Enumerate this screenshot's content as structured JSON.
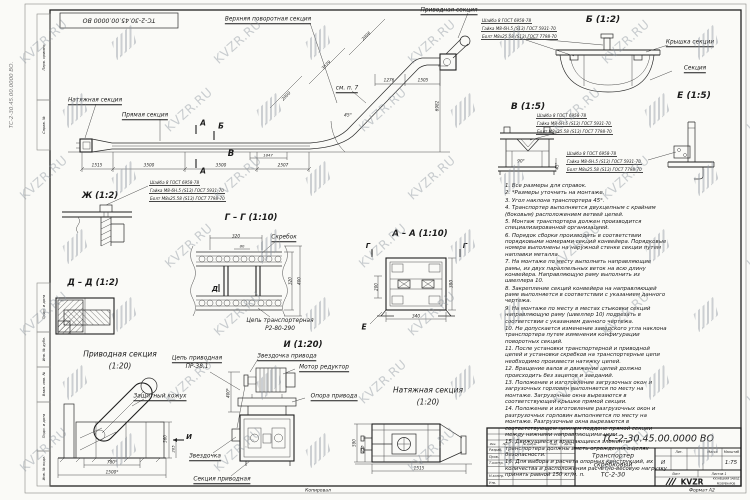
{
  "watermark": {
    "text": "KVZR.RU"
  },
  "fastener_callout": {
    "lines": [
      "Шайба 8 ГОСТ 6958-78",
      "Гайка М8-6Н.5 (S13) ГОСТ 5931-70",
      "Болт М8х25.58 (S13) ГОСТ 7798-70"
    ],
    "positions": [
      {
        "x": 481,
        "y": 18
      },
      {
        "x": 536,
        "y": 113
      },
      {
        "x": 566,
        "y": 151
      },
      {
        "x": 149,
        "y": 180
      }
    ]
  },
  "notes": [
    "1. Все размеры для справок.",
    "2. *Размеры уточнить на монтаже.",
    "3. Угол наклона транспортера 45°.",
    "4. Транспортер выполняется двухцепным с крайним (боковым) расположением ветвей цепей.",
    "5. Монтаж транспортера должен производится специализированной организацией.",
    "6. Порядок сборки производить в соответствии порядковыми номерами секций конвейера. Порядковые номера выполнены на наружной стенке секции путем наплавки металла.",
    "7. На монтаже по месту выполнить направляющие рамы, из двух параллельных веток на всю длину конвейера. Направляющую раму выполнить из швеллера 10.",
    "8. Закрепление секций конвейера на направляющей раме выполняется в соответствии с указанием данного чертежа.",
    "9. На монтаже по месту в местах стыковки секций направляющую раму (швеллер 10) подрезать в соответствии с указанием данного чертежа.",
    "10. Не допускается изменение заводского угла наклона транспортера путем изменения конфигурации поворотных секций.",
    "11. После установки транспортерной и приводной цепей и установки скребков на транспортерные цепи необходимо произвести натяжку цепей.",
    "12. Вращение валов и движение цепей должно происходить без зацепов и заеданий.",
    "13. Положение и изготовление загрузочных окон и загрузочных горловин выполняется по месту на монтаже. Загрузочные окна вырезаются в соответствующей крышке прямой секции.",
    "14. Положение и изготовление разгрузочных окон и разгрузочных горловин выполняется по месту на монтаже. Разгрузочные окна вырезаются в соответствующем нижнем поддоне прямой секции между нижними направляющими цепи.",
    "15. Движущиеся и вращающиеся элементы транспортера должны иметь ограждения в целях безопасности.",
    "16. Для выбора и расчета опорных конструкций, их количества и расположения расчетно-весовую нагрузку принять равной 150 кг/м. п."
  ],
  "text_groups": [
    {
      "name": "frame",
      "items": [
        {
          "n": "doc-number-top-flipped",
          "t": "ТС-2-30.45.00.0000 ВО",
          "x": 119,
          "y": 20,
          "s": 6.2,
          "r": 180
        },
        {
          "n": "doc-number-margin-vertical",
          "t": "ТС-2-30.45.00.0000 ВО.",
          "x": 12,
          "y": 95,
          "s": 5.5,
          "r": -90,
          "col": "#7d7d7d"
        },
        {
          "n": "stamp-inv-podl",
          "t": "Инв. № подл.",
          "x": 43.5,
          "y": 468,
          "s": 3.6,
          "r": -90
        },
        {
          "n": "stamp-podp-data-1",
          "t": "Подп. и дата",
          "x": 43.5,
          "y": 426,
          "s": 3.6,
          "r": -90
        },
        {
          "n": "stamp-vzam-inv",
          "t": "Взам. инв. №",
          "x": 43.5,
          "y": 384,
          "s": 3.6,
          "r": -90
        },
        {
          "n": "stamp-inv-dubl",
          "t": "Инв. № дубл.",
          "x": 43.5,
          "y": 349,
          "s": 3.6,
          "r": -90
        },
        {
          "n": "stamp-podp-data-2",
          "t": "Подп. и дата",
          "x": 43.5,
          "y": 307,
          "s": 3.6,
          "r": -90
        },
        {
          "n": "stamp-sprav",
          "t": "Справ. №",
          "x": 43.5,
          "y": 125,
          "s": 3.6,
          "r": -90
        },
        {
          "n": "stamp-perv-primen",
          "t": "Перв. примен.",
          "x": 43.5,
          "y": 57,
          "s": 3.6,
          "r": -90
        },
        {
          "n": "copied-by",
          "t": "Копировал",
          "x": 318,
          "y": 490.5,
          "s": 4.5
        },
        {
          "n": "sheet-format",
          "t": "Формат А2",
          "x": 702,
          "y": 490.5,
          "s": 4.5
        }
      ]
    },
    {
      "name": "main-elevation",
      "items": [
        {
          "n": "label-tension-section",
          "t": "Натяжная секция",
          "x": 95,
          "y": 101,
          "s": 5.8,
          "u": 1
        },
        {
          "n": "label-straight-section",
          "t": "Прямая секция",
          "x": 145,
          "y": 116,
          "s": 5.8,
          "u": 1
        },
        {
          "n": "label-upper-turn-section",
          "t": "Верхняя поворотная секция",
          "x": 268,
          "y": 20,
          "s": 5.8,
          "u": 1
        },
        {
          "n": "label-drive-section",
          "t": "Приводная секция",
          "x": 449,
          "y": 11,
          "s": 5.8,
          "u": 1
        },
        {
          "n": "label-see-item7",
          "t": "см. п. 7",
          "x": 347,
          "y": 89,
          "s": 5.8,
          "u": 1
        },
        {
          "n": "mark-a-top",
          "t": "А",
          "x": 203,
          "y": 123,
          "s": 7.5,
          "b": 1
        },
        {
          "n": "mark-a-bottom",
          "t": "А",
          "x": 203,
          "y": 171,
          "s": 7.5,
          "b": 1
        },
        {
          "n": "mark-b",
          "t": "Б",
          "x": 221,
          "y": 126,
          "s": 7.5,
          "b": 1
        },
        {
          "n": "mark-v",
          "t": "В",
          "x": 231,
          "y": 154,
          "s": 8.5,
          "b": 1
        },
        {
          "n": "dim-1515",
          "t": "1515",
          "x": 97,
          "y": 165,
          "s": 4.2
        },
        {
          "n": "dim-3500-1",
          "t": "3500",
          "x": 149,
          "y": 165,
          "s": 4.2
        },
        {
          "n": "dim-3500-2",
          "t": "3500",
          "x": 221,
          "y": 165,
          "s": 4.2
        },
        {
          "n": "dim-2507",
          "t": "2507",
          "x": 283,
          "y": 165,
          "s": 4.2
        },
        {
          "n": "dim-1847",
          "t": "1847",
          "x": 268,
          "y": 155,
          "s": 3.8
        },
        {
          "n": "dim-6982",
          "t": "6982",
          "x": 437,
          "y": 106,
          "s": 4.2,
          "r": -90
        },
        {
          "n": "dim-1276",
          "t": "1276",
          "x": 389,
          "y": 80,
          "s": 4.2
        },
        {
          "n": "dim-1505",
          "t": "1505",
          "x": 423,
          "y": 80,
          "s": 4.2
        },
        {
          "n": "dim-2006",
          "t": "2006",
          "x": 366,
          "y": 36,
          "s": 4.2,
          "r": -45
        },
        {
          "n": "dim-3539",
          "t": "3539",
          "x": 326,
          "y": 65,
          "s": 4.2,
          "r": -45
        },
        {
          "n": "dim-2000",
          "t": "2000",
          "x": 286,
          "y": 96,
          "s": 4.2,
          "r": -45
        },
        {
          "n": "dim-45deg",
          "t": "45°",
          "x": 348,
          "y": 116,
          "s": 4.5
        }
      ]
    },
    {
      "name": "view-b",
      "items": [
        {
          "n": "view-b-title",
          "t": "Б (1:2)",
          "x": 603,
          "y": 20,
          "s": 9,
          "b": 1
        },
        {
          "n": "label-section-cover",
          "t": "Крышка секции",
          "x": 690,
          "y": 43,
          "s": 5.8,
          "u": 1
        },
        {
          "n": "label-section",
          "t": "Секция",
          "x": 695,
          "y": 69,
          "s": 5.8,
          "u": 1
        }
      ]
    },
    {
      "name": "view-v",
      "items": [
        {
          "n": "view-v-title",
          "t": "В (1:5)",
          "x": 528,
          "y": 107,
          "s": 9,
          "b": 1
        },
        {
          "n": "dim-90deg",
          "t": "90°",
          "x": 521,
          "y": 161,
          "s": 4.2
        },
        {
          "n": "dim-45deg-v",
          "t": "45°",
          "x": 557,
          "y": 166,
          "s": 4,
          "r": -90
        }
      ]
    },
    {
      "name": "view-e",
      "items": [
        {
          "n": "view-e-title",
          "t": "Е (1:5)",
          "x": 694,
          "y": 96,
          "s": 9,
          "b": 1
        }
      ]
    },
    {
      "name": "view-zh",
      "items": [
        {
          "n": "view-zh-title",
          "t": "Ж (1:2)",
          "x": 100,
          "y": 196,
          "s": 8.5,
          "b": 1
        }
      ]
    },
    {
      "name": "view-gg",
      "items": [
        {
          "n": "view-gg-title",
          "t": "Г – Г (1:10)",
          "x": 251,
          "y": 218,
          "s": 8.5,
          "b": 1
        },
        {
          "n": "label-scraper",
          "t": "Скребок",
          "x": 284,
          "y": 238,
          "s": 5.8,
          "u": 1
        },
        {
          "n": "label-conveyor-chain-1",
          "t": "Цепь транспортерная",
          "x": 280,
          "y": 321,
          "s": 5.8
        },
        {
          "n": "label-conveyor-chain-2",
          "t": "Р2-80-290",
          "x": 280,
          "y": 329,
          "s": 5.8
        },
        {
          "n": "mark-d",
          "t": "Д",
          "x": 215,
          "y": 289,
          "s": 7,
          "b": 1
        },
        {
          "n": "dim-320-top",
          "t": "320",
          "x": 236,
          "y": 235.5,
          "s": 4.2
        },
        {
          "n": "dim-80",
          "t": "80",
          "x": 242,
          "y": 246,
          "s": 3.8
        },
        {
          "n": "dim-320-right",
          "t": "320",
          "x": 290,
          "y": 281,
          "s": 4,
          "r": -90
        },
        {
          "n": "dim-400",
          "t": "400",
          "x": 299,
          "y": 281,
          "s": 4,
          "r": -90
        }
      ]
    },
    {
      "name": "view-aa",
      "items": [
        {
          "n": "view-aa-title",
          "t": "А – А (1:10)",
          "x": 420,
          "y": 234,
          "s": 8.5,
          "b": 1
        },
        {
          "n": "mark-g-left",
          "t": "Г",
          "x": 368,
          "y": 246,
          "s": 7,
          "b": 1
        },
        {
          "n": "mark-g-right",
          "t": "Г",
          "x": 465,
          "y": 246,
          "s": 7,
          "b": 1
        },
        {
          "n": "mark-e",
          "t": "Е",
          "x": 364,
          "y": 327,
          "s": 7.5,
          "b": 1
        },
        {
          "n": "dim-340",
          "t": "340",
          "x": 416,
          "y": 316,
          "s": 4.2
        },
        {
          "n": "dim-380",
          "t": "380",
          "x": 451,
          "y": 284,
          "s": 4.2,
          "r": -90
        },
        {
          "n": "dim-200",
          "t": "200",
          "x": 376,
          "y": 287,
          "s": 4,
          "r": -90
        }
      ]
    },
    {
      "name": "view-dd",
      "items": [
        {
          "n": "view-dd-title",
          "t": "Д – Д (1:2)",
          "x": 93,
          "y": 283,
          "s": 8.5,
          "b": 1
        }
      ]
    },
    {
      "name": "view-i",
      "items": [
        {
          "n": "view-i-title",
          "t": "И (1:20)",
          "x": 303,
          "y": 345,
          "s": 8.5,
          "b": 1
        },
        {
          "n": "label-drive-sprocket",
          "t": "Звездочка привода",
          "x": 287,
          "y": 357,
          "s": 5.8,
          "u": 1
        },
        {
          "n": "label-motor-reducer",
          "t": "Мотор редуктор",
          "x": 324,
          "y": 368,
          "s": 5.8,
          "u": 1
        },
        {
          "n": "label-drive-support",
          "t": "Опора привода",
          "x": 334,
          "y": 397,
          "s": 5.8,
          "u": 1
        },
        {
          "n": "label-drive-chain-1",
          "t": "Цепь приводная",
          "x": 197,
          "y": 359,
          "s": 5.8,
          "u": 1
        },
        {
          "n": "label-drive-chain-2",
          "t": "ПР-38,1",
          "x": 197,
          "y": 367,
          "s": 5.8
        },
        {
          "n": "label-sprocket",
          "t": "Звездочка",
          "x": 205,
          "y": 457,
          "s": 5.8,
          "u": 1
        },
        {
          "n": "label-drive-section-bottom",
          "t": "Секция приводная",
          "x": 222,
          "y": 480,
          "s": 5.8,
          "u": 1
        },
        {
          "n": "dim-400-star",
          "t": "400*",
          "x": 228,
          "y": 393,
          "s": 4,
          "r": -90
        }
      ]
    },
    {
      "name": "view-drive",
      "items": [
        {
          "n": "drive-view-title-1",
          "t": "Приводная секция",
          "x": 120,
          "y": 354,
          "s": 7.5
        },
        {
          "n": "drive-view-title-2",
          "t": "(1:20)",
          "x": 120,
          "y": 366,
          "s": 7.5
        },
        {
          "n": "label-protective-casing",
          "t": "Защитный кожух",
          "x": 160,
          "y": 397,
          "s": 5.8,
          "u": 1
        },
        {
          "n": "dim-560",
          "t": "560",
          "x": 165,
          "y": 439,
          "s": 4,
          "r": -90
        },
        {
          "n": "dim-265",
          "t": "265",
          "x": 172.5,
          "y": 449,
          "s": 3.8,
          "r": -90
        },
        {
          "n": "dim-780-star",
          "t": "780*",
          "x": 112,
          "y": 462,
          "s": 4.2
        },
        {
          "n": "dim-1500-star",
          "t": "1500*",
          "x": 112,
          "y": 472,
          "s": 4.2
        },
        {
          "n": "mark-i",
          "t": "И",
          "x": 189,
          "y": 437,
          "s": 7,
          "b": 1
        }
      ]
    },
    {
      "name": "view-tension",
      "items": [
        {
          "n": "tension-view-title-1",
          "t": "Натяжная секция",
          "x": 428,
          "y": 390,
          "s": 7.5
        },
        {
          "n": "tension-view-title-2",
          "t": "(1:20)",
          "x": 428,
          "y": 402,
          "s": 7.5
        },
        {
          "n": "dim-1515-tension",
          "t": "1515",
          "x": 419,
          "y": 468,
          "s": 4.2
        },
        {
          "n": "dim-590",
          "t": "590",
          "x": 354,
          "y": 443,
          "s": 4,
          "r": -90
        },
        {
          "n": "dim-255",
          "t": "255",
          "x": 362,
          "y": 449,
          "s": 3.8,
          "r": -90
        }
      ]
    },
    {
      "name": "title-block",
      "items": [
        {
          "n": "tb-doc-number",
          "t": "ТС-2-30.45.00.0000 ВО",
          "x": 658,
          "y": 439,
          "s": 9.5
        },
        {
          "n": "tb-name-1",
          "t": "Транспортер",
          "x": 613,
          "y": 456,
          "s": 6.2
        },
        {
          "n": "tb-name-2",
          "t": "скребковый",
          "x": 613,
          "y": 465,
          "s": 6.2
        },
        {
          "n": "tb-name-3",
          "t": "ТС-2-30",
          "x": 613,
          "y": 474.5,
          "s": 6.2
        },
        {
          "n": "tb-col-izm",
          "t": "Изм.",
          "x": 493,
          "y": 443.5,
          "s": 2.8
        },
        {
          "n": "tb-col-list",
          "t": "Лист",
          "x": 506,
          "y": 443.5,
          "s": 2.8
        },
        {
          "n": "tb-col-docnum",
          "t": "№ докум.",
          "x": 530,
          "y": 443.5,
          "s": 2.8
        },
        {
          "n": "tb-col-podp",
          "t": "Подп.",
          "x": 554,
          "y": 443.5,
          "s": 2.8
        },
        {
          "n": "tb-col-data",
          "t": "Дата",
          "x": 568,
          "y": 443.5,
          "s": 2.8
        },
        {
          "n": "tb-row-razrab",
          "t": "Разраб.",
          "x": 489,
          "y": 450.2,
          "s": 3.4,
          "a": "l"
        },
        {
          "n": "tb-row-prov",
          "t": "Пров.",
          "x": 489,
          "y": 456.8,
          "s": 3.4,
          "a": "l"
        },
        {
          "n": "tb-row-tkontr",
          "t": "Т.контр.",
          "x": 489,
          "y": 463.2,
          "s": 3.4,
          "a": "l"
        },
        {
          "n": "tb-row-nkontr",
          "t": "Н.контр.",
          "x": 489,
          "y": 476.2,
          "s": 3.4,
          "a": "l"
        },
        {
          "n": "tb-row-utv",
          "t": "Утв.",
          "x": 489,
          "y": 482.8,
          "s": 3.4,
          "a": "l"
        },
        {
          "n": "tb-lit-header",
          "t": "Лит.",
          "x": 679,
          "y": 452,
          "s": 3.2
        },
        {
          "n": "tb-mass-header",
          "t": "Масса",
          "x": 712.5,
          "y": 452,
          "s": 3.2
        },
        {
          "n": "tb-scale-header",
          "t": "Масштаб",
          "x": 731.5,
          "y": 452,
          "s": 3.2
        },
        {
          "n": "tb-liter-value",
          "t": "И",
          "x": 663,
          "y": 463,
          "s": 5.5
        },
        {
          "n": "tb-scale-value",
          "t": "1:75",
          "x": 731,
          "y": 463,
          "s": 5.5
        },
        {
          "n": "tb-sheet-label",
          "t": "Лист",
          "x": 676,
          "y": 473.5,
          "s": 3.2
        },
        {
          "n": "tb-sheets-label",
          "t": "Листов 1",
          "x": 719,
          "y": 473.5,
          "s": 3.2
        },
        {
          "n": "tb-logo-text",
          "t": "KVZR",
          "x": 692,
          "y": 481.5,
          "s": 7.5,
          "b": 1,
          "i": 0
        },
        {
          "n": "tb-company-1",
          "t": "КУЗНЕЦКИЙ ЗАВОД",
          "x": 726,
          "y": 479,
          "s": 2.6,
          "i": 0
        },
        {
          "n": "tb-company-2",
          "t": "РЕЗЕРВУАРОВ",
          "x": 726,
          "y": 483.5,
          "s": 2.6,
          "i": 0
        }
      ]
    }
  ]
}
